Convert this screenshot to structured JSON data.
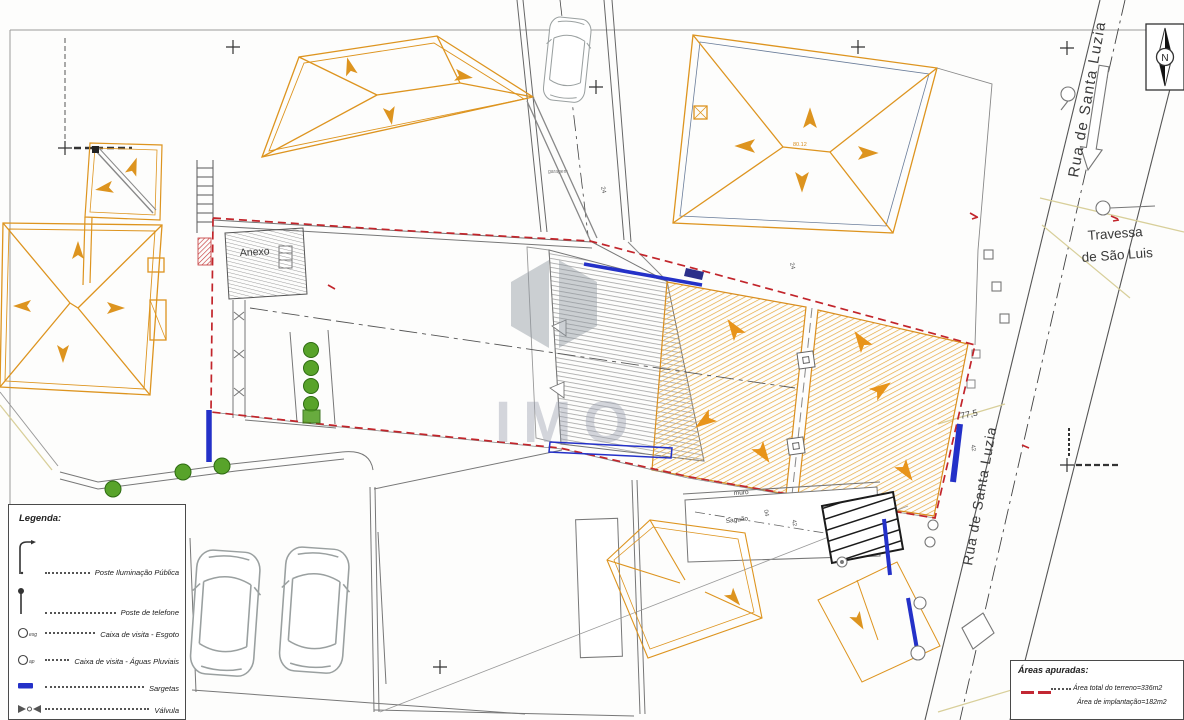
{
  "compass": {
    "n": "N"
  },
  "streets": {
    "rua_top": "Rua de Santa Luzia",
    "rua_bottom": "Rua de Santa Luzia",
    "travessa_l1": "Travessa",
    "travessa_l2": "de São Luis"
  },
  "plan_labels": {
    "anexo": "Anexo",
    "garagem": "garagem",
    "muro": "muro",
    "saguao": "Saguão",
    "dim77": "77,5",
    "roof_level": "80.12"
  },
  "micro_labels": [
    {
      "t": "24"
    },
    {
      "t": "24"
    },
    {
      "t": "04"
    },
    {
      "t": "42"
    },
    {
      "t": "42"
    }
  ],
  "legend": {
    "title": "Legenda:",
    "items": [
      {
        "label": "Poste Iluminação Pública"
      },
      {
        "label": "Poste de telefone"
      },
      {
        "label": "Caixa de visita - Esgoto",
        "suffix": "esg"
      },
      {
        "label": "Caixa de visita - Águas Pluviais",
        "suffix": "ap"
      },
      {
        "label": "Sargetas"
      },
      {
        "label": "Válvula"
      }
    ]
  },
  "areas_box": {
    "title": "Áreas apuradas:",
    "line1": "Área total do terreno=336m2",
    "line2": "Área de implantação=182m2"
  },
  "watermark": "IMO",
  "colors": {
    "building_orange": "#dd941f",
    "boundary_red": "#c2252b",
    "sargeta_blue": "#2431c8",
    "vegetation_green": "#58a32a",
    "pavement_tan": "#d8cf9a",
    "wall_gray": "#888888"
  }
}
